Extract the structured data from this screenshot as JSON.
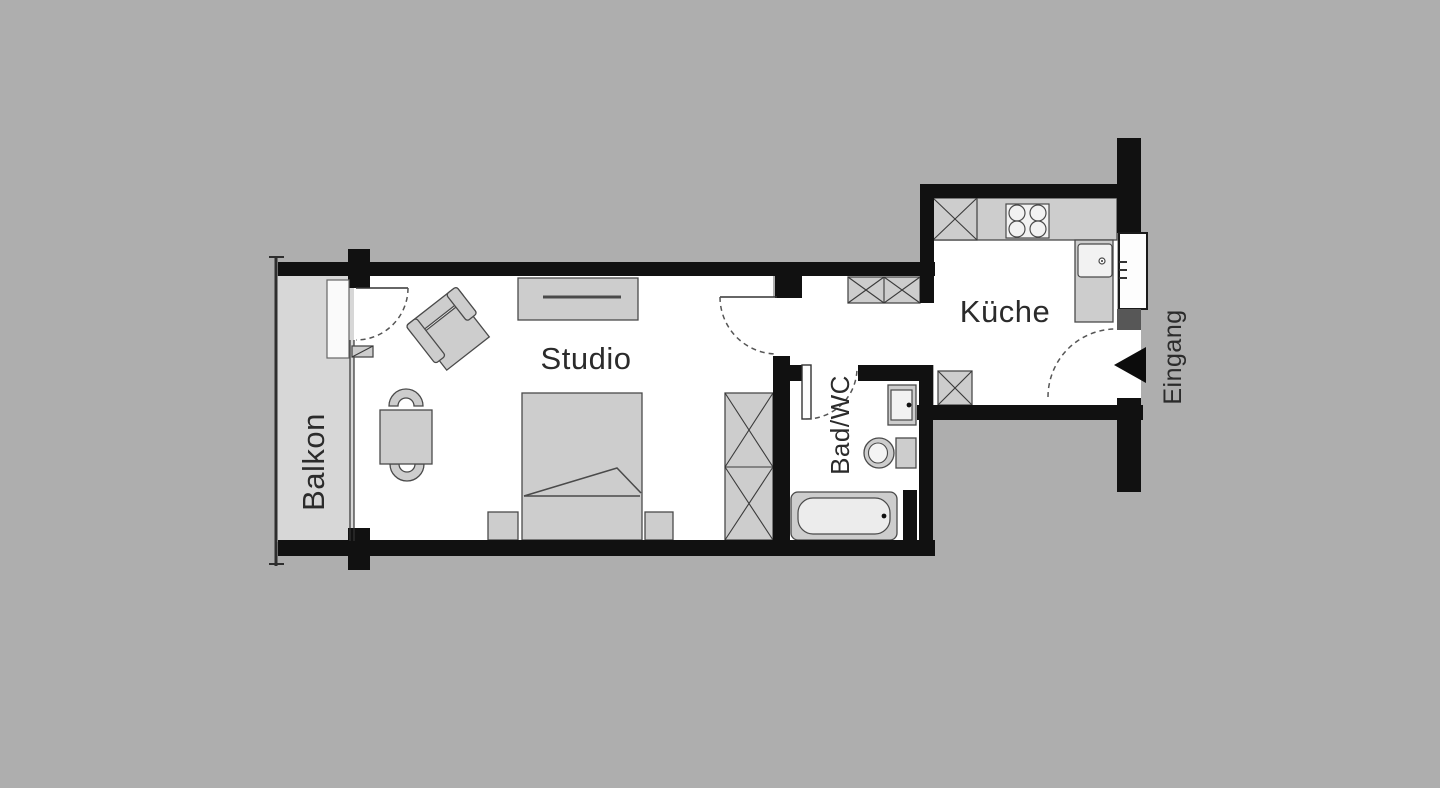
{
  "diagram": {
    "type": "apartment-floor-plan",
    "labels": {
      "balcony": "Balkon",
      "studio": "Studio",
      "bathroom": "Bad/WC",
      "kitchen": "Küche",
      "entrance": "Eingang"
    },
    "colors": {
      "background": "#aeaeae",
      "wall": "#111111",
      "room_floor": "#ffffff",
      "balcony_floor": "#d7d7d7",
      "furniture_fill": "#cdcdcd",
      "furniture_stroke": "#4a4a4a",
      "entrance_niche": "#575757",
      "text": "#2b2b2b"
    }
  }
}
